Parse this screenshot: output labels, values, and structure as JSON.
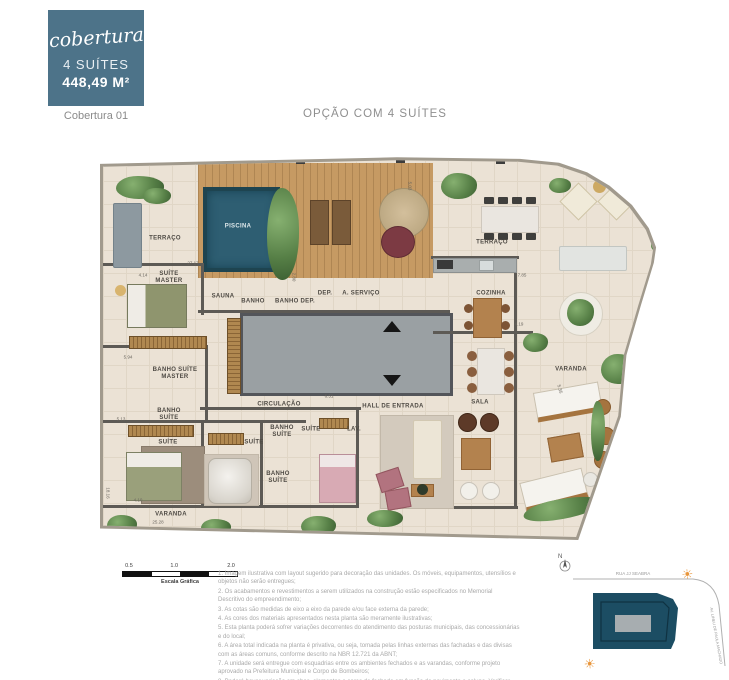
{
  "header": {
    "badge_script": "cobertura",
    "badge_line1": "4 SUÍTES",
    "badge_line2": "448,49 M²",
    "unit_label": "Cobertura 01",
    "title": "OPÇÃO COM 4 SUÍTES",
    "badge_color": "#4d7389"
  },
  "plan": {
    "rooms": {
      "terraco_left": "TERRAÇO",
      "piscina": "PISCINA",
      "suite_master": "SUÍTE MASTER",
      "sauna": "SAUNA",
      "banho": "BANHO",
      "banho_dep": "BANHO DEP.",
      "dep": "DEP.",
      "a_servico": "A. SERVIÇO",
      "terraco_right": "TERRAÇO",
      "cozinha": "COZINHA",
      "banho_suite_master": "BANHO SUÍTE MASTER",
      "banho_suite_1": "BANHO SUÍTE",
      "suite_1": "SUÍTE",
      "suite_2": "SUÍTE",
      "banho_suite_2": "BANHO SUÍTE",
      "suite_3": "SUÍTE",
      "banho_suite_3": "BANHO SUÍTE",
      "lav": "LAV.",
      "circulacao": "CIRCULAÇÃO",
      "hall": "HALL DE ENTRADA",
      "sala": "SALA",
      "varanda_left": "VARANDA",
      "varanda_right": "VARANDA"
    },
    "dims": {
      "top": "27.17",
      "bottom": "25.28",
      "left": "18.16",
      "d1": "5.03",
      "d2": "2.80",
      "d3": "4.14",
      "d4": "5.94",
      "d5": "5.13",
      "d6": "4.10",
      "d7": "6.51",
      "d8": "7.85",
      "d9": "4.19",
      "d10": "5.35"
    }
  },
  "scale": {
    "t1": "0.5",
    "t2": "1.0",
    "t3": "2.0",
    "caption": "Escala Gráfica"
  },
  "notes": [
    "1.  Imagem ilustrativa com layout sugerido para decoração das unidades. Os móveis, equipamentos, utensílios e objetos não serão entregues;",
    "2.  Os acabamentos e revestimentos a serem utilizados na construção estão especificados no Memorial Descritivo do empreendimento;",
    "3.  As cotas são medidas de eixo a eixo da parede e/ou face externa da parede;",
    "4.  As cores dos materiais apresentados nesta planta são meramente ilustrativas;",
    "5.  Esta planta poderá sofrer variações decorrentes do atendimento das posturas municipais, das concessionárias e do local;",
    "6.  A área total indicada na planta é privativa, ou seja, tomada pelas linhas externas das fachadas e das divisas com as áreas comuns, conforme descrito na NBR 12.721 da ABNT;",
    "7.  A unidade será entregue com esquadrias entre os ambientes fechados e as varandas, conforme projeto aprovado na Prefeitura Municipal e Corpo de Bombeiros;",
    "8.  Poderá haver variação em abas, elementos e cores da fachada em função do pavimento e coluna. Verificar imagens da fachada e maquete."
  ],
  "keyplan": {
    "north": "N",
    "street_top": "RUA JJ SEABRA",
    "street_right": "AV. LINEU DE PAULA MACHADO",
    "building_color": "#1c4d63",
    "sun_glyph": "☀"
  }
}
